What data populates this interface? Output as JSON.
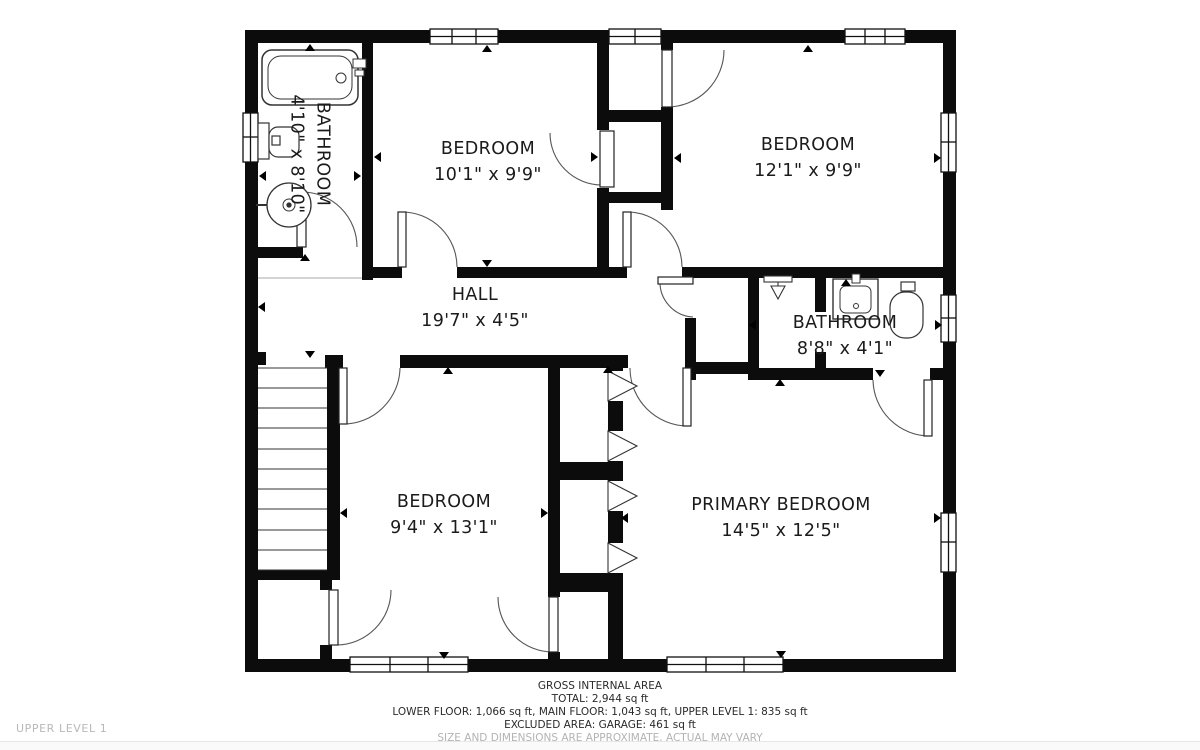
{
  "page": {
    "floor_label": "UPPER LEVEL 1"
  },
  "rooms": {
    "bathroom_upper_left": {
      "name": "BATHROOM",
      "dims": "4'10\" x 8'10\""
    },
    "bedroom_top_middle": {
      "name": "BEDROOM",
      "dims": "10'1\" x 9'9\""
    },
    "bedroom_top_right": {
      "name": "BEDROOM",
      "dims": "12'1\" x 9'9\""
    },
    "hall": {
      "name": "HALL",
      "dims": "19'7\" x 4'5\""
    },
    "bathroom_right": {
      "name": "BATHROOM",
      "dims": "8'8\" x 4'1\""
    },
    "bedroom_bottom_left": {
      "name": "BEDROOM",
      "dims": "9'4\" x 13'1\""
    },
    "primary_bedroom": {
      "name": "PRIMARY BEDROOM",
      "dims": "14'5\" x 12'5\""
    }
  },
  "footer": {
    "title": "GROSS INTERNAL AREA",
    "total": "TOTAL: 2,944 sq ft",
    "floors": "LOWER FLOOR: 1,066 sq ft, MAIN FLOOR: 1,043 sq ft, UPPER LEVEL 1: 835 sq ft",
    "excluded": "EXCLUDED AREA: GARAGE: 461 sq ft",
    "disclaimer": "SIZE AND DIMENSIONS ARE APPROXIMATE, ACTUAL MAY VARY"
  },
  "colors": {
    "wall": "#0c0c0c",
    "fixture_line": "#333333",
    "arc": "#555555",
    "muted": "#b8b8b8"
  }
}
